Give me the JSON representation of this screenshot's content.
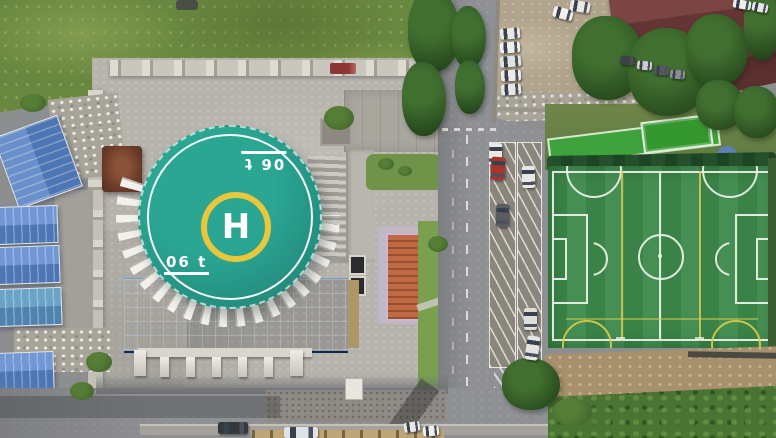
{
  "scene": {
    "kind": "aerial-drone-photo",
    "description": "Overhead view of a campus with a rooftop helipad on a glass building, blue warehouse roofs, a tree-lined road with angled parking bays, a dirt car lot and a green soccer field",
    "helipad": {
      "center_letter": "H",
      "weight_marking_bottom": "06 t",
      "weight_marking_top_rotated": "06 t",
      "pad_color": "#279a8b",
      "outer_ring_color": "#ffffff",
      "touchdown_ring_color": "#e9c73c",
      "marking_color": "#ffffff"
    },
    "soccer_field": {
      "surface_color": "#3e8a4c",
      "boundary_line_color": "#edf3e9",
      "secondary_line_color": "#d9ca4e",
      "features": [
        "center circle",
        "center line",
        "penalty areas",
        "penalty arcs",
        "corner arcs",
        "yellow cross-pitch lines"
      ]
    },
    "colors": {
      "grass_meadow": "#69883f",
      "dirt_lot": "#b2a48c",
      "plaza_paving": "#b6b3ad",
      "asphalt_road": "#8f9094",
      "glass_roof_blue": "#24497f",
      "warehouse_roof_blue": "#5f86c2",
      "maroon_roof": "#6e3c3a",
      "tree_green": "#2d5322",
      "shrub_green": "#4a7433",
      "walkway_green": "#3fa23c",
      "pavilion_roof_brown": "#6b3a28",
      "orange_structure": "#c06a45"
    },
    "vehicles": {
      "road_cars": [
        "white",
        "red",
        "dark-gray",
        "white",
        "white",
        "white"
      ],
      "lot_cars": [
        "white",
        "white",
        "white",
        "white",
        "white",
        "white",
        "white"
      ],
      "street_cars": [
        "dark",
        "white-bus",
        "white",
        "white"
      ]
    }
  }
}
